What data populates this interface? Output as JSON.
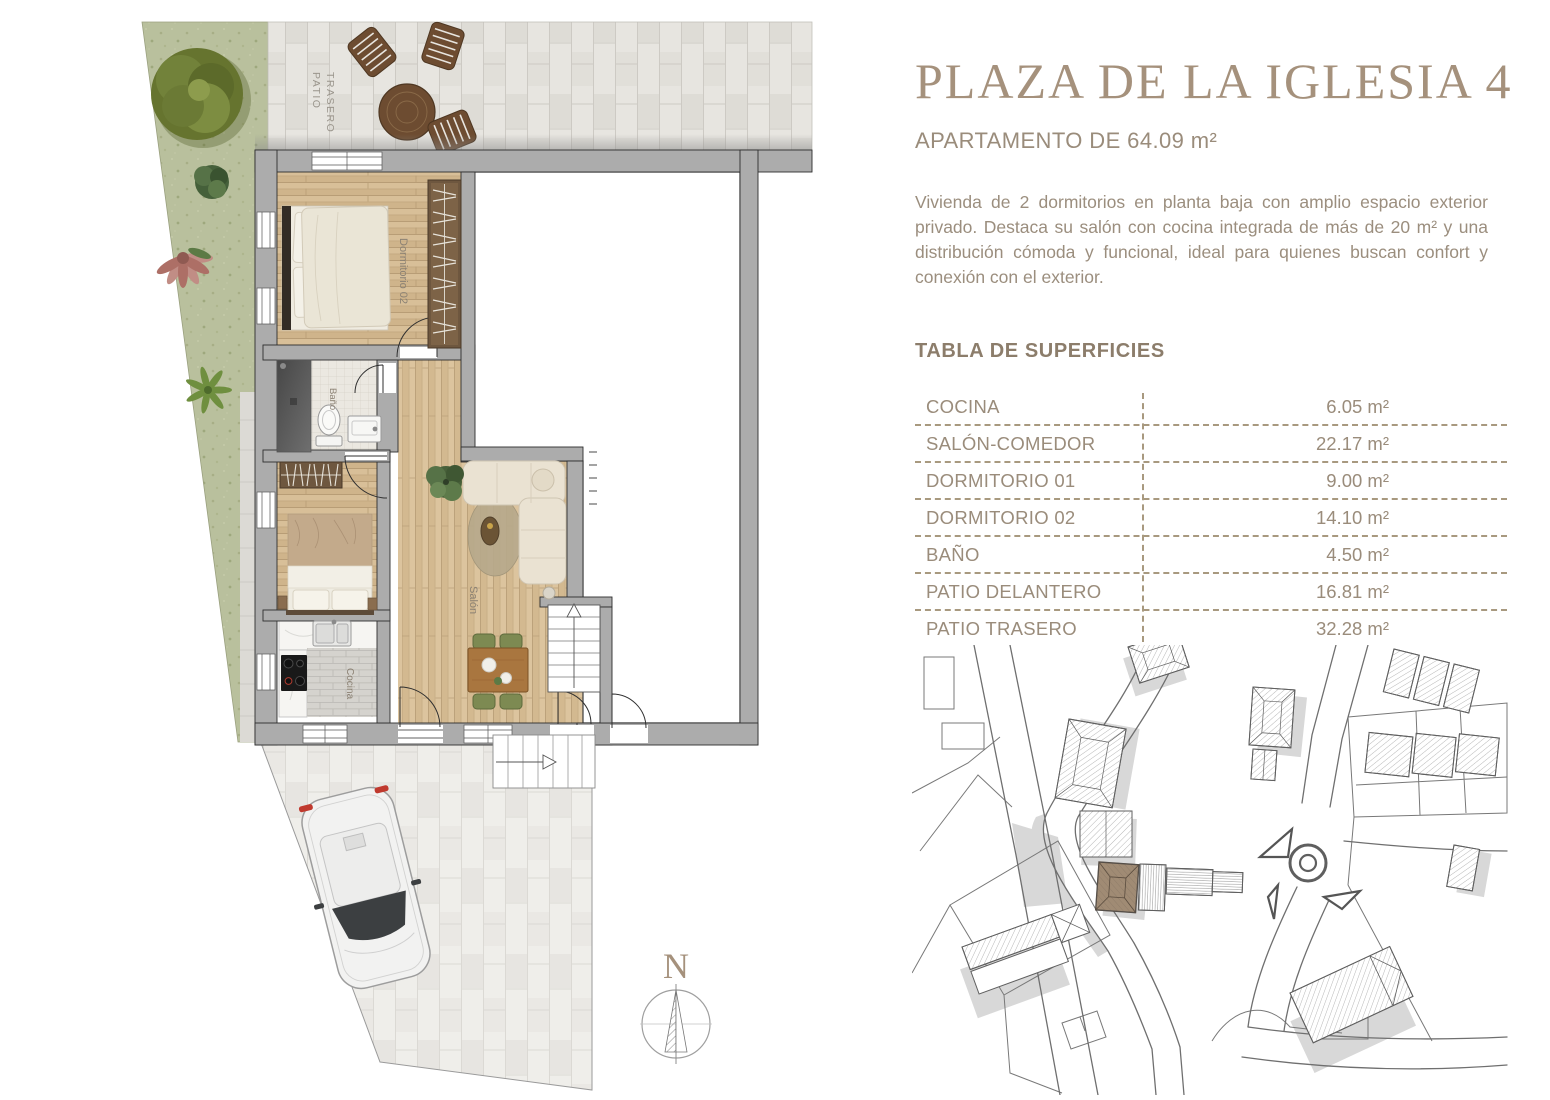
{
  "title": "PLAZA DE LA IGLESIA 4",
  "subtitle": "APARTAMENTO DE 64.09 m²",
  "description": "Vivienda de 2 dormitorios en planta baja con amplio espacio exterior privado. Destaca su salón con cocina integrada de más de 20 m² y una distribución cómoda y funcional, ideal para quienes buscan confort y conexión con el exterior.",
  "surfaces": {
    "heading": "TABLA DE SUPERFICIES",
    "rows": [
      {
        "label": "COCINA",
        "value": "6.05 m²"
      },
      {
        "label": "SALÓN-COMEDOR",
        "value": "22.17 m²"
      },
      {
        "label": "DORMITORIO 01",
        "value": "9.00 m²"
      },
      {
        "label": "DORMITORIO 02",
        "value": "14.10 m²"
      },
      {
        "label": "BAÑO",
        "value": "4.50 m²"
      },
      {
        "label": "PATIO DELANTERO",
        "value": "16.81 m²"
      },
      {
        "label": "PATIO TRASERO",
        "value": "32.28 m²"
      }
    ]
  },
  "floorplan": {
    "labels": {
      "patio_trasero_lines": [
        "PATIO",
        "TRASERO"
      ],
      "dormitorio_02": "Dormitorio 02",
      "bano": "Baño",
      "salon": "Salón",
      "cocina": "Cocina"
    },
    "compass_north": "N"
  },
  "colors": {
    "accent_taupe": "#a5917c",
    "text_brown": "#9a8c7b",
    "wall_gray": "#acacac",
    "wood_floor": "#d5bb93",
    "garden_green": "#b9c09d",
    "highlight_building": "#a08b74"
  }
}
